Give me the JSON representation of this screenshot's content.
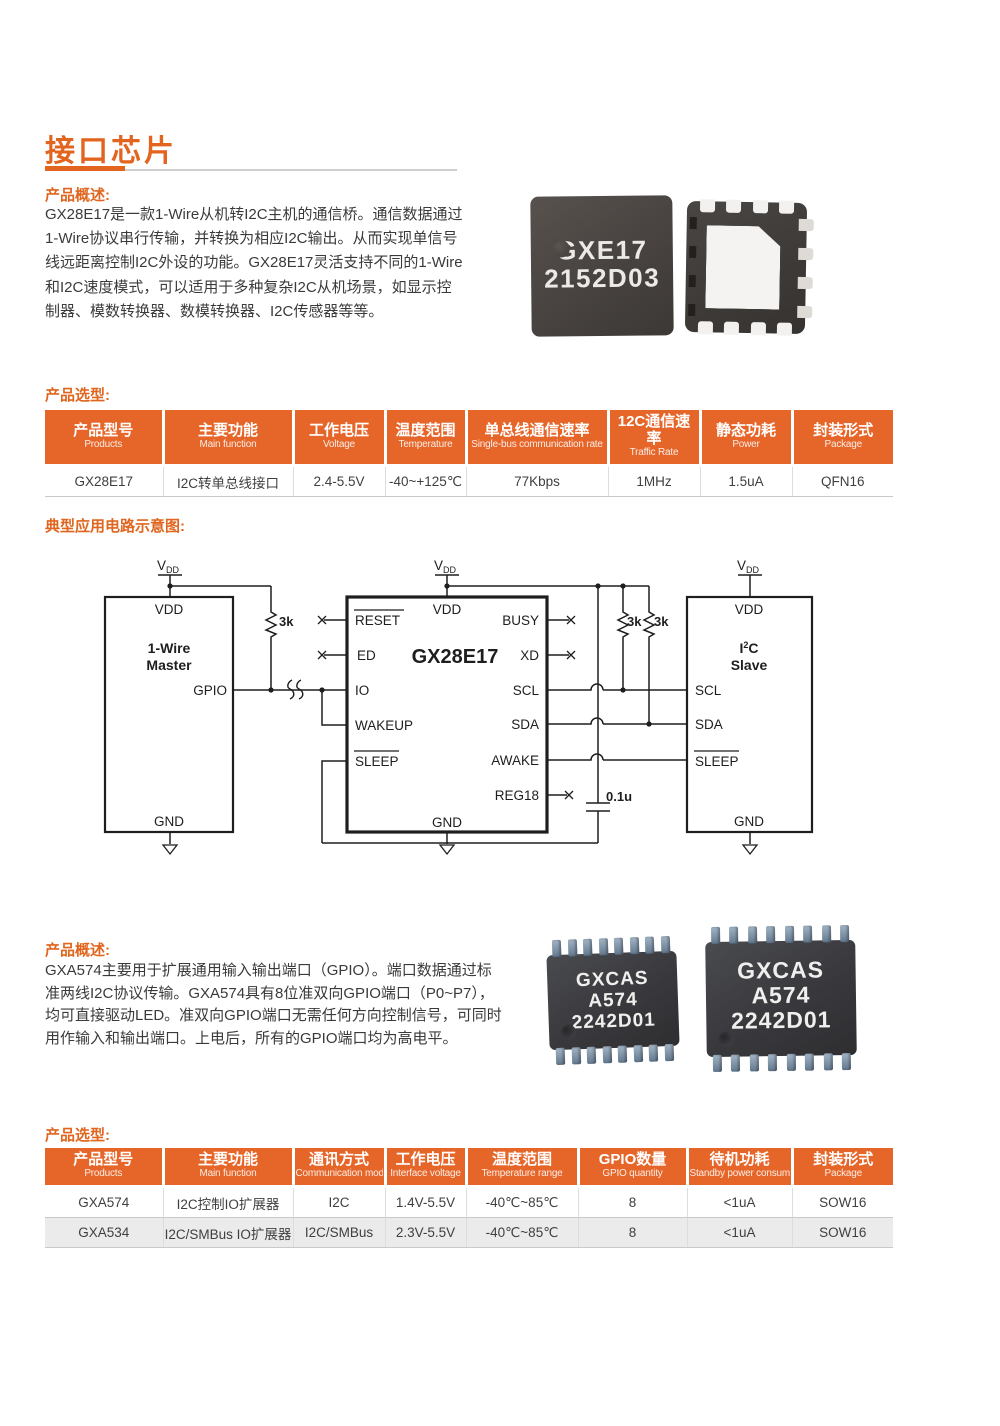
{
  "colors": {
    "accent": "#E6662A",
    "title_orange": "#E2641F",
    "row_alt": "#EBEBEB",
    "text": "#3C3C3C"
  },
  "title": "接口芯片",
  "section1": {
    "overview_label": "产品概述:",
    "overview_lines": [
      "GX28E17是一款1-Wire从机转I2C主机的通信桥。通信数据通过",
      "1-Wire协议串行传输，并转换为相应I2C输出。从而实现单信号",
      "线远距离控制I2C外设的功能。GX28E17灵活支持不同的1-Wire",
      "和I2C速度模式，可以适用于多种复杂I2C从机场景，如显示控",
      "制器、模数转换器、数模转换器、I2C传感器等等。"
    ],
    "chip_marking": {
      "0": "GXE17",
      "1": "2152D03"
    },
    "selection_label": "产品选型:",
    "table": {
      "headers": [
        {
          "zh": "产品型号",
          "en": "Products"
        },
        {
          "zh": "主要功能",
          "en": "Main function"
        },
        {
          "zh": "工作电压",
          "en": "Voltage"
        },
        {
          "zh": "温度范围",
          "en": "Temperature"
        },
        {
          "zh": "单总线通信速率",
          "en": "Single-bus communication rate"
        },
        {
          "zh": "12C通信速率",
          "en": "Traffic Rate"
        },
        {
          "zh": "静态功耗",
          "en": "Power"
        },
        {
          "zh": "封装形式",
          "en": "Package"
        }
      ],
      "rows": [
        [
          "GX28E17",
          "I2C转单总线接口",
          "2.4-5.5V",
          "-40~+125℃",
          "77Kbps",
          "1MHz",
          "1.5uA",
          "QFN16"
        ]
      ]
    }
  },
  "circuit": {
    "caption": "典型应用电路示意图:",
    "supply": {
      "v": "V",
      "sub": "DD"
    },
    "master": {
      "vdd": "VDD",
      "line1": "1-Wire",
      "line2": "Master",
      "gpio": "GPIO",
      "gnd": "GND"
    },
    "chip": {
      "vdd": "VDD",
      "reset": "RESET",
      "ed": "ED",
      "io": "IO",
      "wakeup": "WAKEUP",
      "sleep": "SLEEP",
      "name": "GX28E17",
      "busy": "BUSY",
      "xd": "XD",
      "scl": "SCL",
      "sda": "SDA",
      "awake": "AWAKE",
      "reg18": "REG18",
      "gnd": "GND"
    },
    "slave": {
      "vdd": "VDD",
      "i": "I",
      "sup": "2",
      "c": "C",
      "line2": "Slave",
      "scl": "SCL",
      "sda": "SDA",
      "sleep": "SLEEP",
      "gnd": "GND"
    },
    "r1": "3k",
    "r2": "3k",
    "r3": "3k",
    "cap": "0.1u"
  },
  "section2": {
    "overview_label": "产品概述:",
    "overview_lines": [
      "GXA574主要用于扩展通用输入输出端口（GPIO）。端口数据通过标",
      "准两线I2C协议传输。GXA574具有8位准双向GPIO端口（P0~P7），",
      "均可直接驱动LED。准双向GPIO端口无需任何方向控制信号，可同时",
      "用作输入和输出端口。上电后，所有的GPIO端口均为高电平。"
    ],
    "chip_marking": {
      "0": "GXCAS",
      "1": "A574",
      "2": "2242D01"
    },
    "selection_label": "产品选型:",
    "table": {
      "headers": [
        {
          "zh": "产品型号",
          "en": "Products"
        },
        {
          "zh": "主要功能",
          "en": "Main function"
        },
        {
          "zh": "通讯方式",
          "en": "Communication mode"
        },
        {
          "zh": "工作电压",
          "en": "Interface voltage"
        },
        {
          "zh": "温度范围",
          "en": "Temperature range"
        },
        {
          "zh": "GPIO数量",
          "en": "GPIO quantity"
        },
        {
          "zh": "待机功耗",
          "en": "Standby power consumption"
        },
        {
          "zh": "封装形式",
          "en": "Package"
        }
      ],
      "rows": [
        [
          "GXA574",
          "I2C控制IO扩展器",
          "I2C",
          "1.4V-5.5V",
          "-40℃~85℃",
          "8",
          "<1uA",
          "SOW16"
        ],
        [
          "GXA534",
          "I2C/SMBus IO扩展器",
          "I2C/SMBus",
          "2.3V-5.5V",
          "-40℃~85℃",
          "8",
          "<1uA",
          "SOW16"
        ]
      ]
    }
  }
}
